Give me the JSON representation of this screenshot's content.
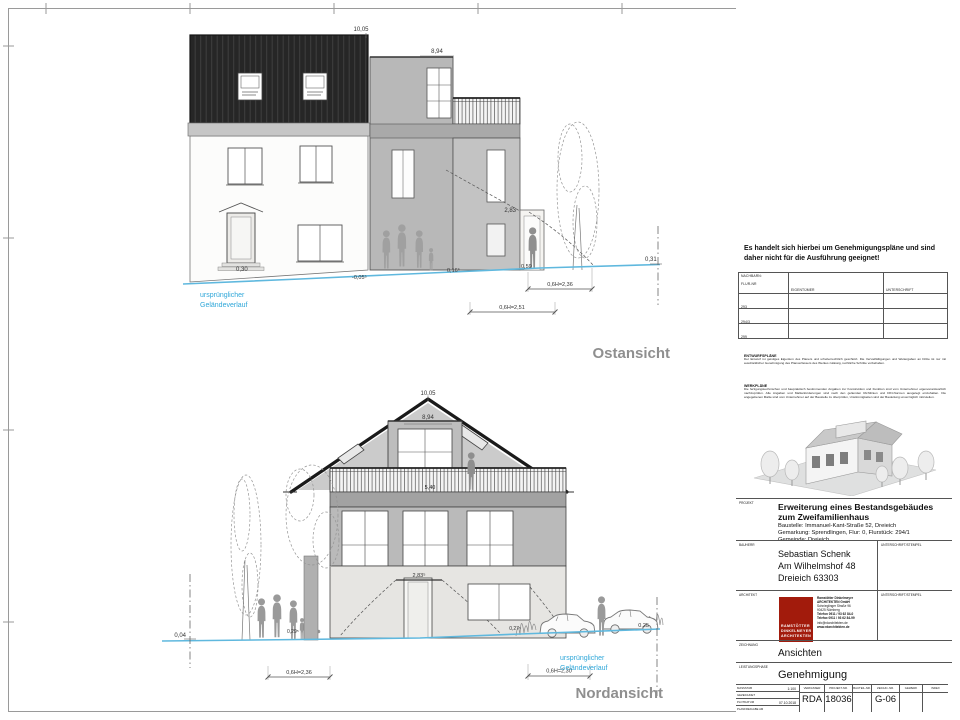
{
  "colors": {
    "accent_blue": "#2fa7d9",
    "terrain_blue": "#5fb8de",
    "roof_dark": "#262626",
    "logo_red": "#a21b0c",
    "view_title_gray": "#8f8f8f"
  },
  "drawings": {
    "east": {
      "title": "Ostansicht",
      "ridge_height": "10,05",
      "flat_height": "8,94",
      "door_height": "2,83",
      "level_door": "0,30",
      "level_a": "-0,05⁵",
      "level_b": "0,16⁵",
      "level_c": "0,59",
      "level_right": "0,31",
      "dim_a": "0,6H=2,36",
      "dim_b": "0,6H=2,51",
      "terrain1": "ursprünglicher",
      "terrain2": "Geländeverlauf"
    },
    "north": {
      "title": "Nordansicht",
      "ridge_height": "10,05",
      "flat_height": "8,94",
      "balcony_width": "5,40",
      "door_height": "2,83⁵",
      "level_left": "0,04",
      "level_a": "0,29⁵",
      "level_b": "0,27⁵",
      "level_right": "0,25",
      "dim_a": "0,6H=2,36",
      "dim_b": "0,6H=2,30",
      "terrain1": "ursprünglicher",
      "terrain2": "Geländeverlauf"
    }
  },
  "titleblock": {
    "notice": "Es handelt sich hierbei um Genehmigungspläne und sind daher  nicht für die Ausführung geeignet!",
    "neighbors": {
      "header1a": "NACHBARN:",
      "header1b": "FLUR-NR",
      "header2": "EIGENTÜMER",
      "header3": "UNTERSCHRIFT",
      "rows": [
        {
          "flur": "293"
        },
        {
          "flur": "294/3"
        },
        {
          "flur": "299"
        }
      ]
    },
    "entwurf_title": "ENTWURFSPLÄNE",
    "entwurf_text": "Der Entwurf ist geistiges Eigentum des Planers und urheberrechtlich geschützt. Die Vervielfältigungen und Weitergaben an Dritte ist nur mit ausdrücklicher Genehmigung des Planverfassers des Werkes zulässig, rechtliche Schritte vorbehalten.",
    "werk_title": "WERKPLÄNE",
    "werk_text": "Die fertigungstechnischen und baupraktisch bestimmenden Angaben zur Konstruktion und Funktion sind vom Unternehmer eigenverantwortlich nachzuprüfen. Alle Angaben und Maßanforderungen sind nach den geltenden Richtlinien und DIN-Normen ausgelegt einzuhalten. Die angegebenen Maße sind vom Unternehmer auf der Baustelle zu überprüfen, Unstimmigkeiten sind der Bauleitung unverzüglich mitzuteilen.",
    "projekt_label": "PROJEKT",
    "projekt_title": "Erweiterung eines Bestandsgebäudes zum Zweifamilienhaus",
    "projekt_line1": "Baustelle: Immanuel-Kant-Straße 52, Dreieich",
    "projekt_line2": "Gemarkung: Sprendlingen, Flur: 0, Flurstück: 294/1",
    "projekt_line3": "Gemeinde: Dreieich",
    "bauherr_label": "BAUHERR",
    "bauherr_name": "Sebastian Schenk",
    "bauherr_street": "Am Wilhelmshof 48",
    "bauherr_city": "Dreieich 63303",
    "unterschrift_label": "UNTERSCHRIFT/STEMPEL",
    "architekt_label": "ARCHITEKT",
    "logo": {
      "line1": "RAMSTÖTTER",
      "line2": "DINKELMEYER",
      "line3": "ARCHITEKTEN"
    },
    "contact": {
      "l0": "Ramstötter Dinkelmeyer",
      "l1": "ARCHITEKTEN  GmbH",
      "l2": "Schnieglinger Straße 96",
      "l3": "90425  Nürnberg",
      "l4": "Telefon 0911 / 93 62 84-0",
      "l5": "Telefax 0911 / 93 62 84-99",
      "l6": "info@rdarchitekten.de",
      "l7": "www.rdarchitekten.de"
    },
    "zeichnung_label": "ZEICHNUNG",
    "zeichnung_value": "Ansichten",
    "leistungsphase_label": "LEISTUNGSPHASE",
    "leistungsphase_value": "Genehmigung",
    "meta": {
      "massstab_label": "MASSSTAB",
      "massstab_value": "1:100",
      "gezeichnet_label": "GEZEICHNET",
      "gezeichnet_value": "",
      "plotdatum_label": "PLOTDATUM",
      "plotdatum_value": "07.10.2018",
      "planfreigabe_label": "PLANFREIGABE AM",
      "planfreigabe_value": "",
      "columns": [
        {
          "label": "VERFASSER",
          "value": "RDA"
        },
        {
          "label": "PROJEKT-NR.",
          "value": "18036"
        },
        {
          "label": "BAUTEIL-NR.",
          "value": ""
        },
        {
          "label": "ZEICHN.-NR.",
          "value": "G-06"
        },
        {
          "label": "GEWERK",
          "value": ""
        },
        {
          "label": "INDEX",
          "value": ""
        }
      ]
    }
  }
}
